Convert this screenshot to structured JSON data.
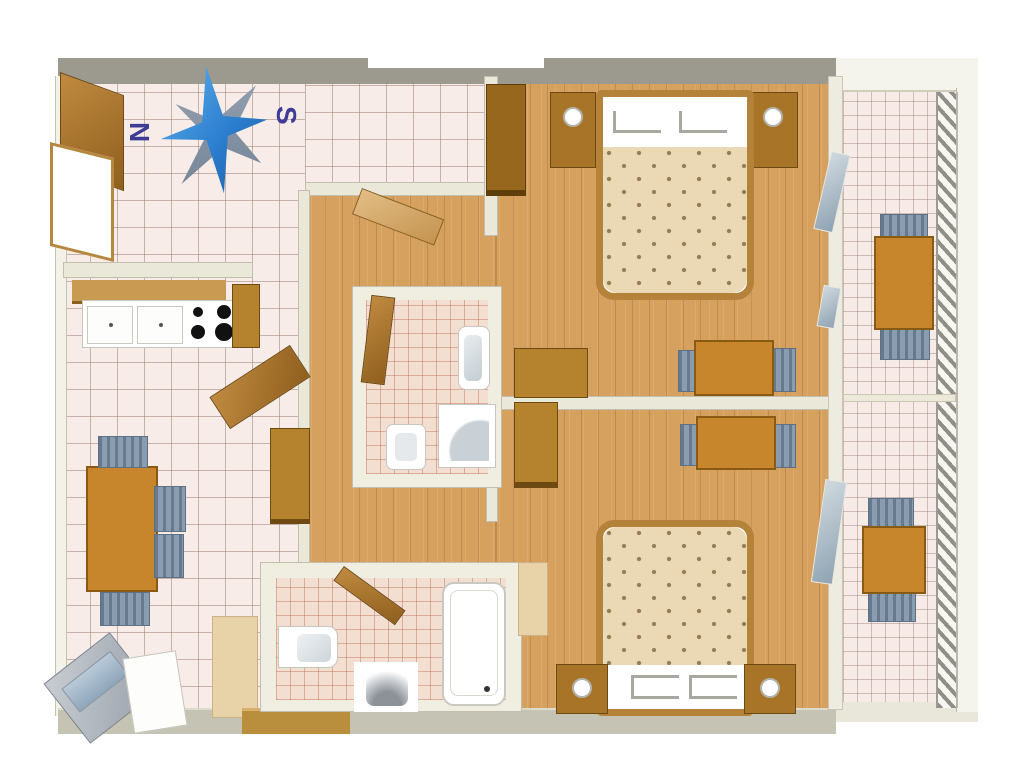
{
  "compass": {
    "north_label": "N",
    "south_label": "S"
  },
  "colors": {
    "wall_outer": "#9c9a8f",
    "wall_inner": "#eae8d9",
    "wall_bottom": "#c5c4b4",
    "tile_floor": "#f7ece8",
    "bath_tile": "#f3ded2",
    "wood_floor": "#d6a05f",
    "furniture_brown": "#b5822e",
    "chair_gray": "#8a9cb0",
    "bed_duvet": "#ead9b4",
    "bed_frame": "#b5823a",
    "compass_blue": "#2d7fd0",
    "compass_letter": "#3f3c96",
    "rug_beige": "#e8d3a8"
  },
  "rooms": [
    {
      "id": "entrance-hall",
      "floor": "tile"
    },
    {
      "id": "kitchen",
      "floor": "tile"
    },
    {
      "id": "living-dining",
      "floor": "tile"
    },
    {
      "id": "hallway",
      "floor": "wood"
    },
    {
      "id": "bathroom-upper",
      "floor": "tile"
    },
    {
      "id": "bathroom-lower",
      "floor": "tile"
    },
    {
      "id": "bedroom-north",
      "floor": "wood"
    },
    {
      "id": "bedroom-south",
      "floor": "wood"
    },
    {
      "id": "balcony-north",
      "floor": "tile"
    },
    {
      "id": "balcony-south",
      "floor": "tile"
    }
  ],
  "furniture": {
    "kitchen": [
      "wall-shelf",
      "counter-cabinets",
      "stove-4-burners",
      "tall-cabinet",
      "door"
    ],
    "living_dining": [
      "dining-table",
      "chairs-x4",
      "tv-unit",
      "sideboard",
      "rug",
      "threshold"
    ],
    "hallway": [
      "cabinet",
      "door"
    ],
    "bathroom_upper": [
      "washbasin",
      "shower",
      "toilet",
      "door"
    ],
    "bathroom_lower": [
      "washbasin",
      "toilet",
      "bathtub",
      "door"
    ],
    "bedroom_north": [
      "double-bed",
      "nightstand-x2",
      "wardrobe",
      "cabinet",
      "table",
      "chairs-x2",
      "balcony-glass-door"
    ],
    "bedroom_south": [
      "double-bed",
      "nightstand-x2",
      "wardrobe",
      "rug",
      "table",
      "chairs-x2",
      "balcony-glass-door"
    ],
    "balcony_north": [
      "table",
      "chairs-x2",
      "railing"
    ],
    "balcony_south": [
      "table",
      "chairs-x2",
      "railing"
    ]
  }
}
